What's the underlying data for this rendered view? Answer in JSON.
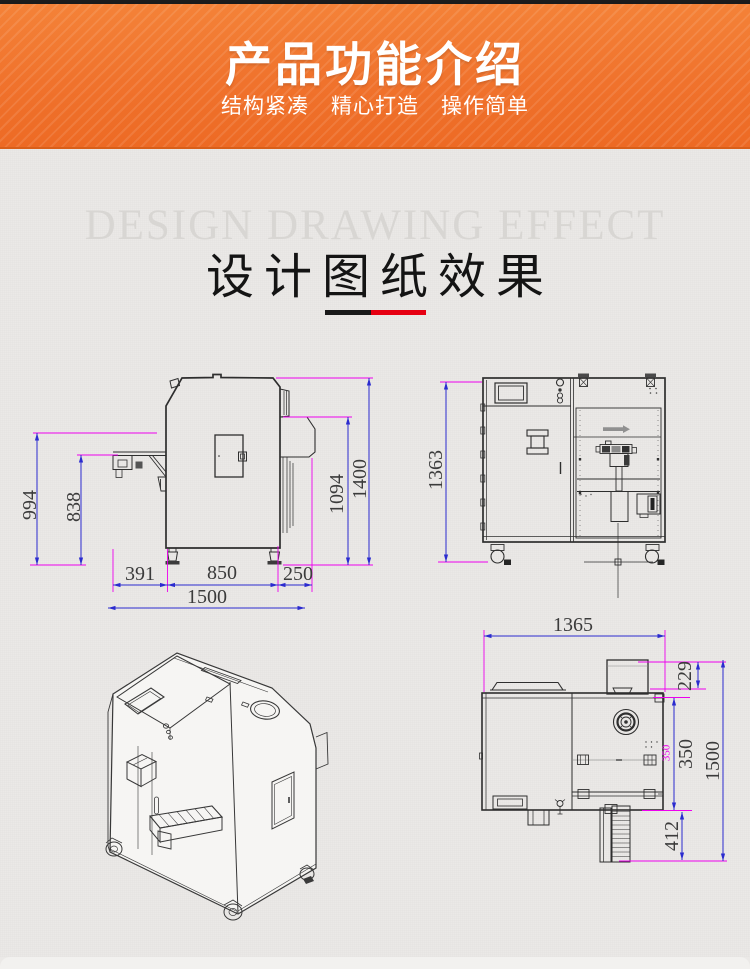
{
  "header": {
    "title": "产品功能介绍",
    "subtitle": "结构紧凑　精心打造　操作简单"
  },
  "design": {
    "watermark": "DESIGN DRAWING EFFECT",
    "title": "设计图纸效果"
  },
  "views": {
    "side": {
      "d994": "994",
      "d838": "838",
      "d1094": "1094",
      "d1400": "1400",
      "d391": "391",
      "d850": "850",
      "d250": "250",
      "d1500": "1500"
    },
    "front": {
      "d1363": "1363"
    },
    "top": {
      "d1365": "1365",
      "d229": "229",
      "d350": "350",
      "d350_small": "350",
      "d412": "412",
      "d1500": "1500"
    }
  },
  "colors": {
    "banner_orange": "#f0722c",
    "dim_line_blue": "#2b2bcf",
    "ext_line_magenta": "#ee00ee",
    "divider_black": "#1a1a1a",
    "divider_red": "#e60012",
    "sketch_line": "#2e2e2e"
  }
}
